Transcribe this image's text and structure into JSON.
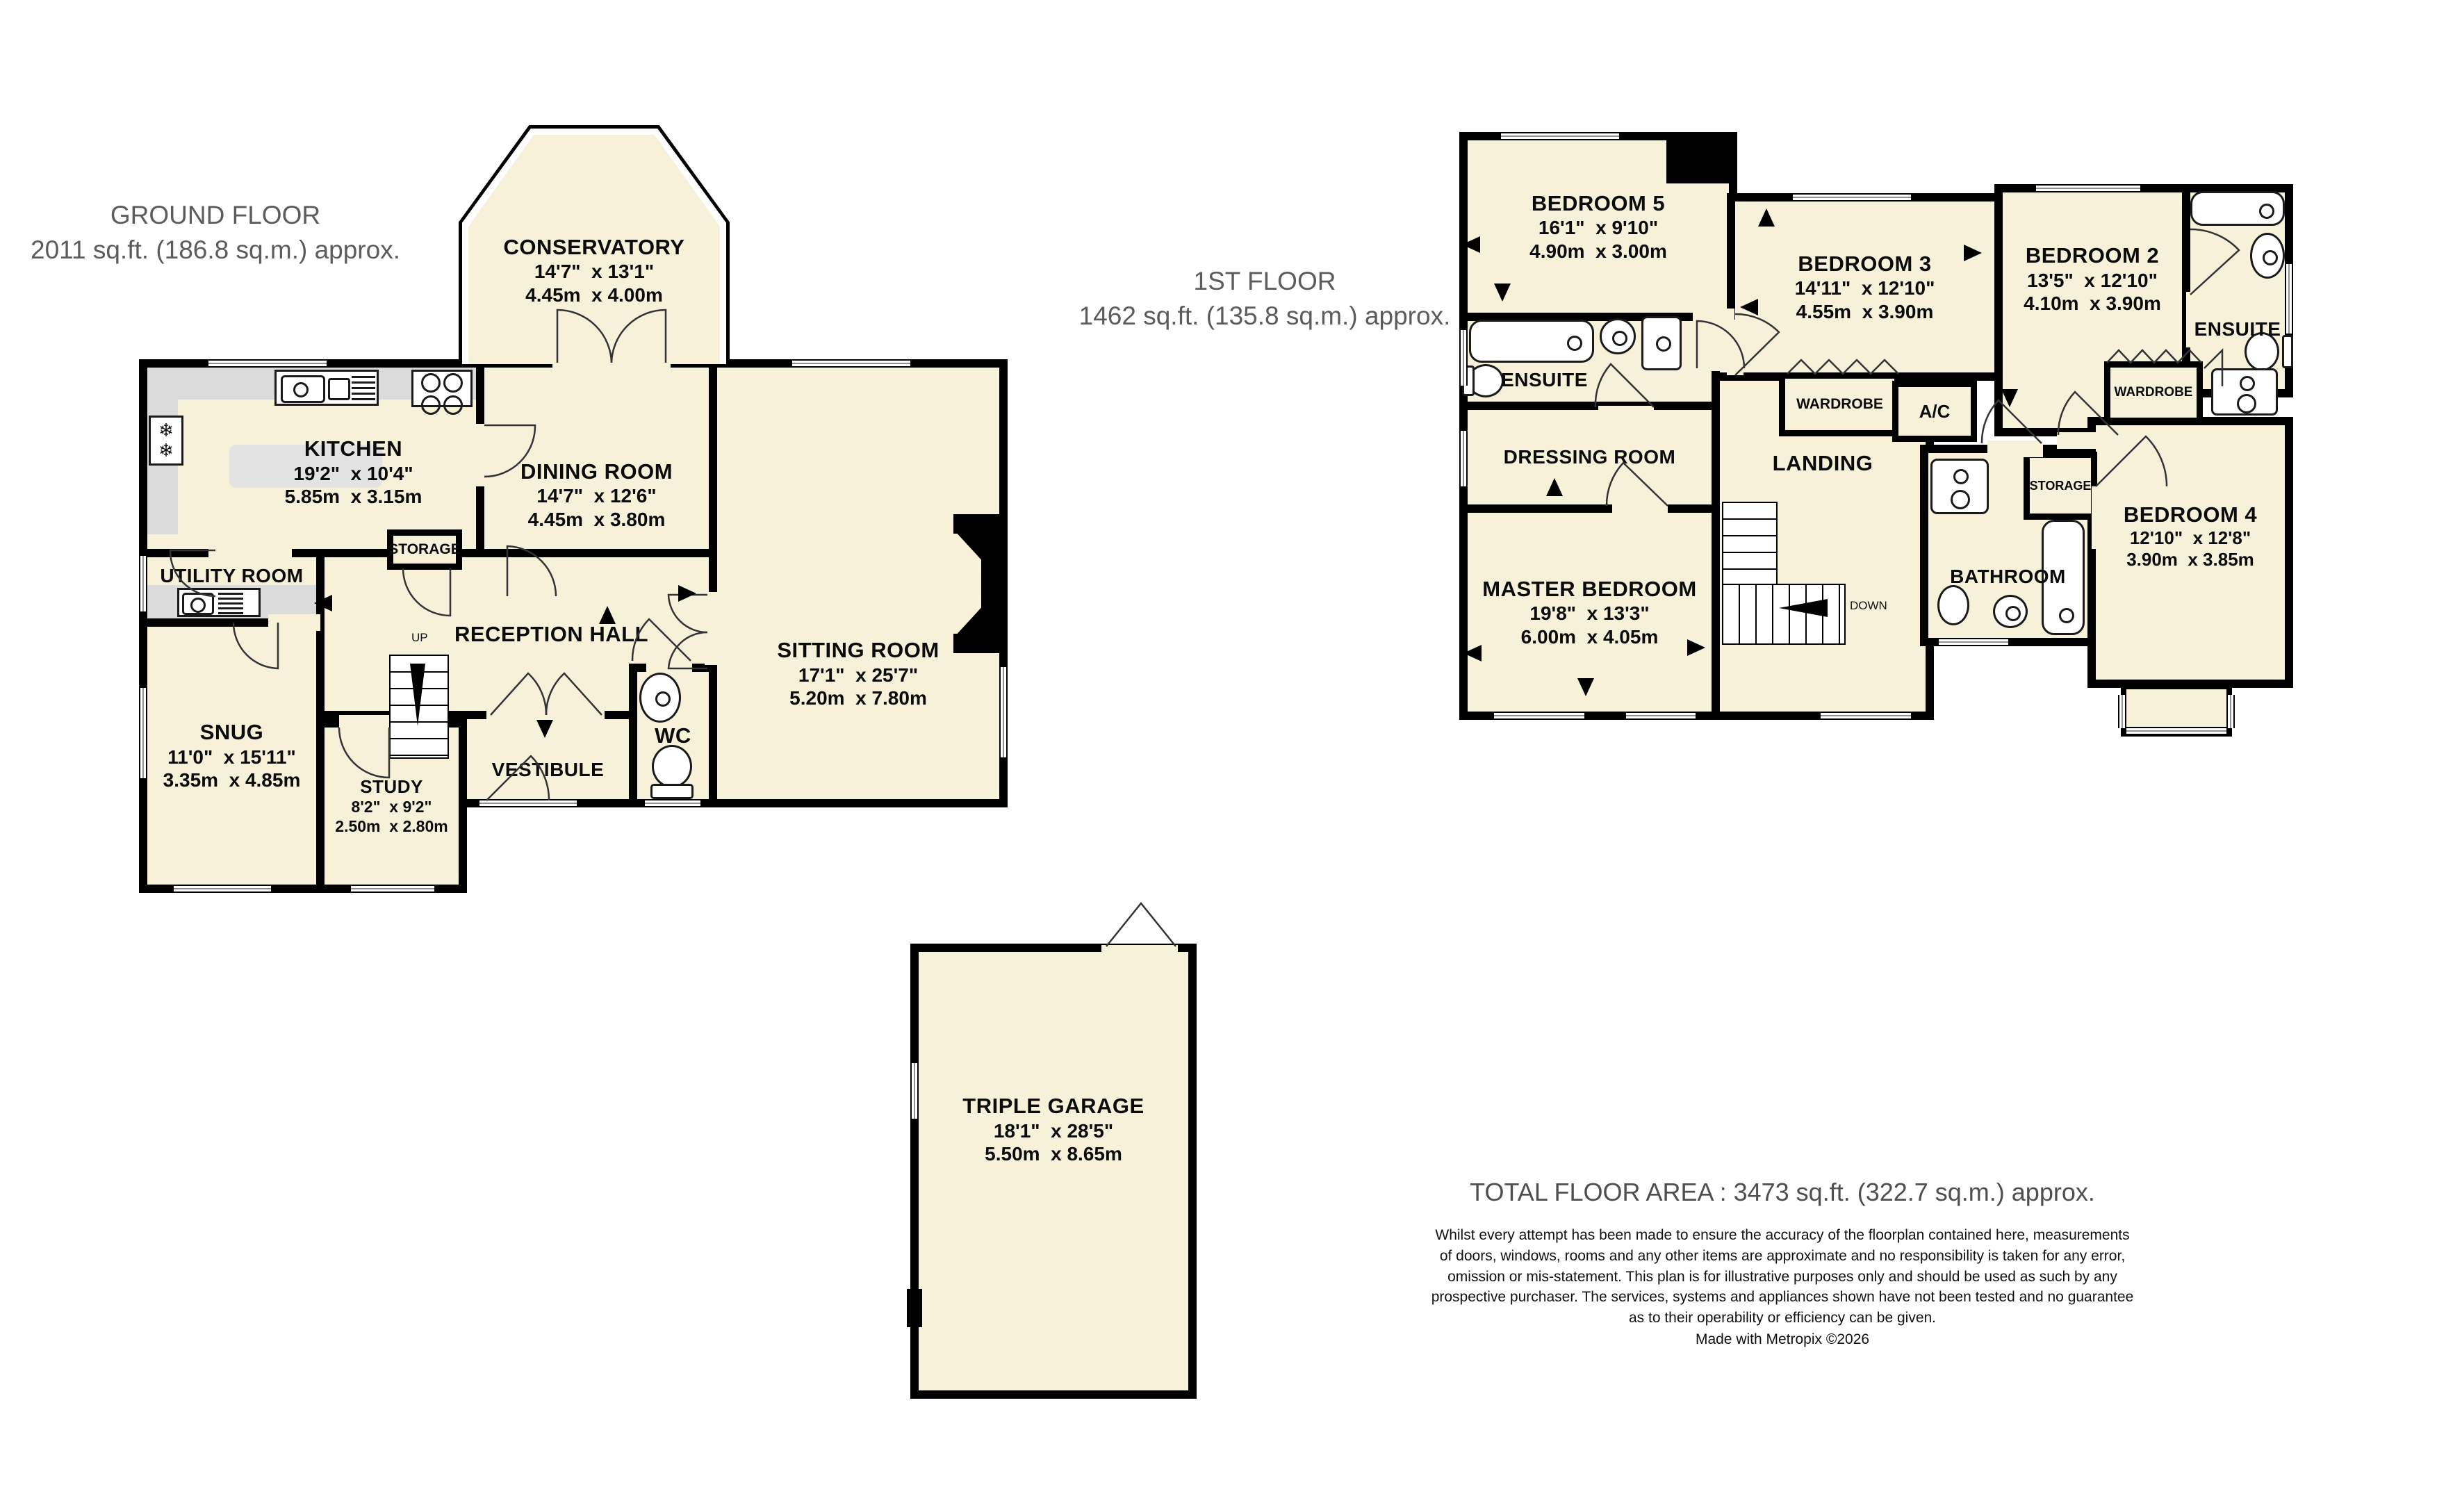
{
  "ground": {
    "title": "GROUND FLOOR",
    "subtitle": "2011 sq.ft. (186.8 sq.m.) approx.",
    "up_label": "UP",
    "rooms": {
      "conservatory": {
        "name": "CONSERVATORY",
        "imperial": "14'7\"  x 13'1\"",
        "metric": "4.45m  x 4.00m"
      },
      "kitchen": {
        "name": "KITCHEN",
        "imperial": "19'2\"  x 10'4\"",
        "metric": "5.85m  x 3.15m"
      },
      "dining": {
        "name": "DINING ROOM",
        "imperial": "14'7\"  x 12'6\"",
        "metric": "4.45m  x 3.80m"
      },
      "sitting": {
        "name": "SITTING ROOM",
        "imperial": "17'1\"  x 25'7\"",
        "metric": "5.20m  x 7.80m"
      },
      "utility": {
        "name": "UTILITY ROOM"
      },
      "storage": {
        "name": "STORAGE"
      },
      "reception": {
        "name": "RECEPTION HALL"
      },
      "snug": {
        "name": "SNUG",
        "imperial": "11'0\"  x 15'11\"",
        "metric": "3.35m  x 4.85m"
      },
      "study": {
        "name": "STUDY",
        "imperial": "8'2\"  x 9'2\"",
        "metric": "2.50m  x 2.80m"
      },
      "vestibule": {
        "name": "VESTIBULE"
      },
      "wc": {
        "name": "WC"
      },
      "garage": {
        "name": "TRIPLE GARAGE",
        "imperial": "18'1\"  x 28'5\"",
        "metric": "5.50m  x 8.65m"
      }
    }
  },
  "first": {
    "title": "1ST FLOOR",
    "subtitle": "1462 sq.ft. (135.8 sq.m.) approx.",
    "down_label": "DOWN",
    "rooms": {
      "bed5": {
        "name": "BEDROOM 5",
        "imperial": "16'1\"  x 9'10\"",
        "metric": "4.90m  x 3.00m"
      },
      "bed3": {
        "name": "BEDROOM 3",
        "imperial": "14'11\"  x 12'10\"",
        "metric": "4.55m  x 3.90m"
      },
      "bed2": {
        "name": "BEDROOM 2",
        "imperial": "13'5\"  x 12'10\"",
        "metric": "4.10m  x 3.90m"
      },
      "bed4": {
        "name": "BEDROOM 4",
        "imperial": "12'10\"  x 12'8\"",
        "metric": "3.90m  x 3.85m"
      },
      "master": {
        "name": "MASTER BEDROOM",
        "imperial": "19'8\"  x 13'3\"",
        "metric": "6.00m  x 4.05m"
      },
      "ensuite_left": {
        "name": "ENSUITE"
      },
      "ensuite_right": {
        "name": "ENSUITE"
      },
      "dressing": {
        "name": "DRESSING ROOM"
      },
      "landing": {
        "name": "LANDING"
      },
      "wardrobe_left": {
        "name": "WARDROBE"
      },
      "wardrobe_right": {
        "name": "WARDROBE"
      },
      "ac": {
        "name": "A/C"
      },
      "storage": {
        "name": "STORAGE"
      },
      "bathroom": {
        "name": "BATHROOM"
      }
    }
  },
  "footer": {
    "total": "TOTAL FLOOR AREA : 3473 sq.ft. (322.7 sq.m.) approx.",
    "disclaimer": "Whilst every attempt has been made to ensure the accuracy of the floorplan contained here, measurements\nof doors, windows, rooms and any other items are approximate and no responsibility is taken for any error,\nomission or mis-statement. This plan is for illustrative purposes only and should be used as such by any\nprospective purchaser. The services, systems and appliances shown have not been tested and no guarantee\nas to their operability or efficiency can be given.",
    "credit": "Made with Metropix ©2026"
  },
  "colors": {
    "room_fill": "#F7F1DA",
    "wall": "#000000",
    "counter": "#DBDBDB",
    "title_text": "#5C5C5C"
  }
}
